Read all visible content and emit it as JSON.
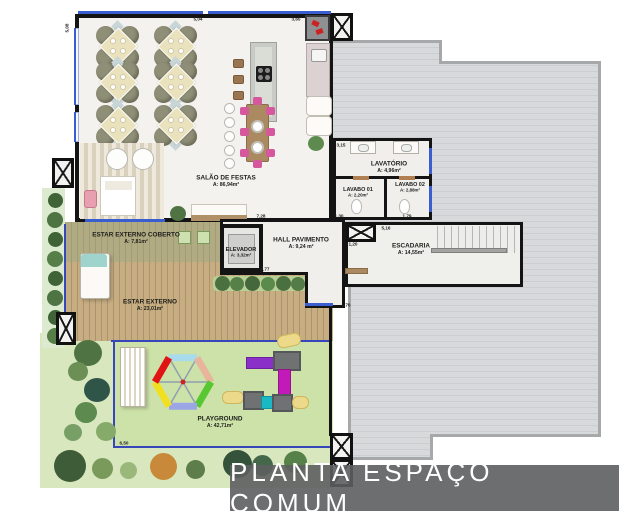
{
  "title": "PLANTA ESPAÇO COMUM",
  "rooms": {
    "salao": {
      "name": "SALÃO DE FESTAS",
      "area": "A: 86,94m²"
    },
    "lavatorio": {
      "name": "LAVATÓRIO",
      "area": "A: 4,96m²"
    },
    "lavabo01": {
      "name": "LAVABO 01",
      "area": "A: 2,20m²"
    },
    "lavabo02": {
      "name": "LAVABO 02",
      "area": "A: 2,88m²"
    },
    "elevador": {
      "name": "ELEVADOR",
      "area": "A: 3,32m²"
    },
    "hall": {
      "name": "HALL PAVIMENTO",
      "area": "A: 9,24 m²"
    },
    "escadaria": {
      "name": "ESCADARIA",
      "area": "A: 14,55m²"
    },
    "estar_coberto": {
      "name": "ESTAR EXTERNO COBERTO",
      "area": "A: 7,81m²"
    },
    "estar_externo": {
      "name": "ESTAR EXTERNO",
      "area": "A: 23,01m²"
    },
    "playground": {
      "name": "PLAYGROUND",
      "area": "A: 42,71m²"
    }
  },
  "dimensions": {
    "left_top_v": "5,08",
    "top_1": "5,04",
    "top_2": "3,65",
    "wc_top": "3,15",
    "wc_bottom_1": "1,30",
    "wc_bottom_2": "1,79",
    "hall_top": "7,28",
    "hall_mid": "1,77",
    "hall_bottom": "1,70",
    "esc_left": "1,20",
    "esc_top": "5,16",
    "playground_bottom": "6,50"
  },
  "colors": {
    "window_glass_blue": "#3a5ed0",
    "boundary_blue": "#3746b8",
    "roof_slab_gray": "#d7d9db",
    "wall_black": "#141414",
    "deck_wood": "#c6ad82",
    "grass_green": "#cde2a8",
    "title_bar_gray": "#5d5e60",
    "title_text_white": "#ffffff",
    "carousel_colors": [
      "#e01414",
      "#a8dcec",
      "#e8b49c",
      "#58c832",
      "#9aa6e6",
      "#f2e020"
    ],
    "slide_purple": "#8b2fc9",
    "slide_magenta": "#c219b9",
    "slide_teal": "#1ab8c4"
  }
}
